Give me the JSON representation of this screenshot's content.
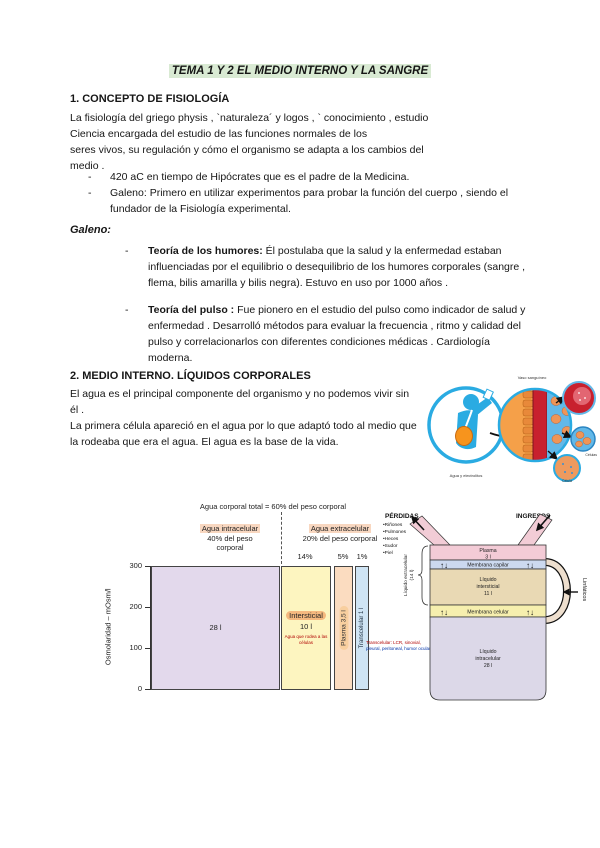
{
  "doc": {
    "title": "TEMA 1 Y 2 EL MEDIO INTERNO Y LA SANGRE"
  },
  "section1": {
    "heading": "1. CONCEPTO DE FISIOLOGÍA",
    "lines": [
      "La fisiología del griego physis , `naturaleza´ y logos , ` conocimiento , estudio",
      "Ciencia encargada del estudio de las funciones normales de los",
      "seres vivos, su regulación y cómo el organismo se adapta a los cambios del",
      "medio ."
    ],
    "bullet_dash": "-",
    "bullets": [
      "420 aC en tiempo de Hipócrates que es el padre de la Medicina.",
      "Galeno: Primero en utilizar experimentos para probar la función del cuerpo , siendo el fundador de la Fisiología experimental."
    ]
  },
  "galeno": {
    "heading": "Galeno:",
    "items": [
      {
        "term": "Teoría de los humores:",
        "text": " Él postulaba que la salud y la enfermedad estaban influenciadas por el equilibrio o desequilibrio de los humores corporales (sangre , flema, bilis amarilla y bilis negra). Estuvo en uso por 1000 años ."
      },
      {
        "term": "Teoría del pulso :",
        "text": " Fue pionero en el estudio del pulso como indicador de salud y enfermedad . Desarrolló métodos para evaluar la frecuencia , ritmo y calidad del pulso y correlacionarlos con diferentes condiciones médicas . Cardiología moderna."
      }
    ]
  },
  "section2": {
    "heading": "2. MEDIO INTERNO. LÍQUIDOS CORPORALES",
    "p1": "El agua es el principal componente del organismo y no podemos vivir sin él .",
    "p2": "La primera célula apareció en el agua por lo que adaptó todo al medio que la rodeaba que era el agua. El agua es la base de la vida."
  },
  "illustration": {
    "label_top": "Vaso sanguíneo",
    "label_person": "Agua y electrolitos",
    "label_cells": "Células",
    "label_cell": "Célula"
  },
  "chart_data": {
    "type": "bar",
    "title": "Agua corporal total = 60% del peso corporal",
    "ylabel": "Osmolaridad – mOsm/l",
    "ylim": [
      0,
      300
    ],
    "ytick_labels": [
      "300",
      "200",
      "100",
      "0"
    ],
    "group_labels": [
      {
        "label": "Agua intracelular",
        "sub1": "40% del peso",
        "sub2": "corporal"
      },
      {
        "label": "Agua extracelular",
        "sub1": "20% del peso corporal"
      }
    ],
    "compartments": [
      {
        "name": "Intracelular",
        "volume_label": "28 l",
        "percent_label": "",
        "osmolarity": 280
      },
      {
        "name": "Intersticial",
        "volume_label": "10 l",
        "percent_label": "14%",
        "osmolarity": 280
      },
      {
        "name": "Plasma",
        "volume_label": "Plasma 3,5 l",
        "percent_label": "5%",
        "osmolarity": 280
      },
      {
        "name": "Transcelular",
        "volume_label": "Transcelular 1 l",
        "percent_label": "1%",
        "osmolarity": 280
      }
    ],
    "micro_note_interstitial": "Agua que rodea a las células",
    "micro_note_transcellular_1": "Transcelular: LCR, sinovial,",
    "micro_note_transcellular_2": "pleural, peritoneal, humor ocular…"
  },
  "fluids_diagram": {
    "perdidas": {
      "title": "PÉRDIDAS",
      "items": [
        "•Riñones",
        "•Pulmones",
        "•Heces",
        "•Sudor",
        "•Piel"
      ]
    },
    "ingresos": "INGRESOS",
    "bands": [
      {
        "l1": "Plasma",
        "l2": "3 l"
      },
      {
        "l1": "Membrana capilar"
      },
      {
        "l1": "Líquido",
        "l2": "intersticial",
        "l3": "11 l"
      },
      {
        "l1": "Membrana celular"
      },
      {
        "l1": "Líquido",
        "l2": "intracelular",
        "l3": "28 l"
      }
    ],
    "extracellular_l1": "Líquido extracelular",
    "extracellular_l2": "(14 l)",
    "linfaticos": "Linfáticos",
    "arrow_pair": "↑↓"
  },
  "colors": {
    "highlight_green": "#d9ead3",
    "highlight_peach": "#f8d7c0",
    "intracellular_box": "#e3d9ec",
    "interstitial_box": "#fdf5c0",
    "plasma_box": "#fbdcc0",
    "transcellular_box": "#cfe4f4",
    "plasma_band": "#f3cbd6",
    "capillary_membrane_band": "#ccd9ef",
    "interstitial_band": "#e9d9b4",
    "cell_membrane_band": "#f6efae",
    "intracellular_band": "#dcd8e8",
    "figure_blue": "#2aabe2",
    "vessel_red": "#c8202e",
    "cell_orange": "#f5a049"
  }
}
